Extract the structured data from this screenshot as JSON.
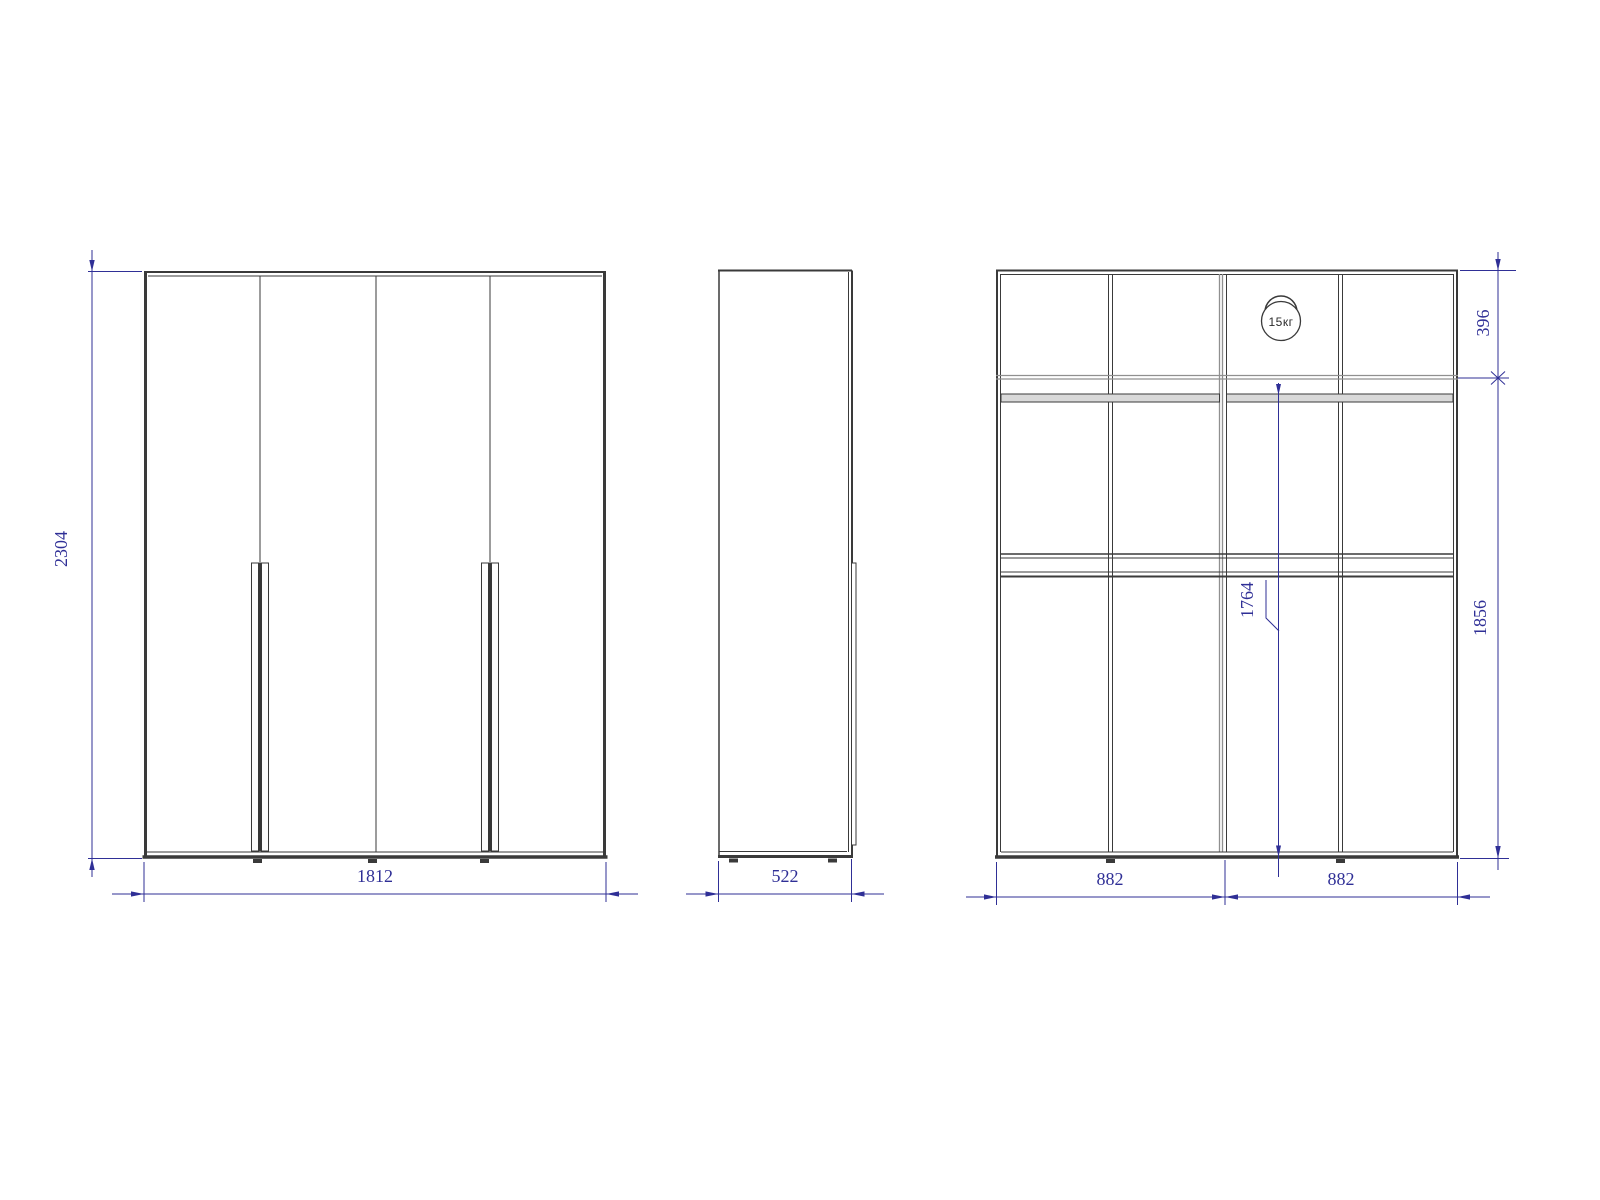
{
  "drawing": {
    "type": "furniture-technical-drawing",
    "subject": "four-door wardrobe, three orthographic views",
    "colors": {
      "background": "#ffffff",
      "structure_line": "#3a3a3a",
      "secondary_line": "#909090",
      "dimension": "#2f2f96"
    },
    "front_view": {
      "height_label": "2304",
      "width_label": "1812"
    },
    "side_view": {
      "depth_label": "522"
    },
    "internal_view": {
      "top_section_label": "396",
      "lower_section_label": "1856",
      "rod_height_label": "1764",
      "left_half_label": "882",
      "right_half_label": "882",
      "load_badge_label": "15кг"
    }
  }
}
